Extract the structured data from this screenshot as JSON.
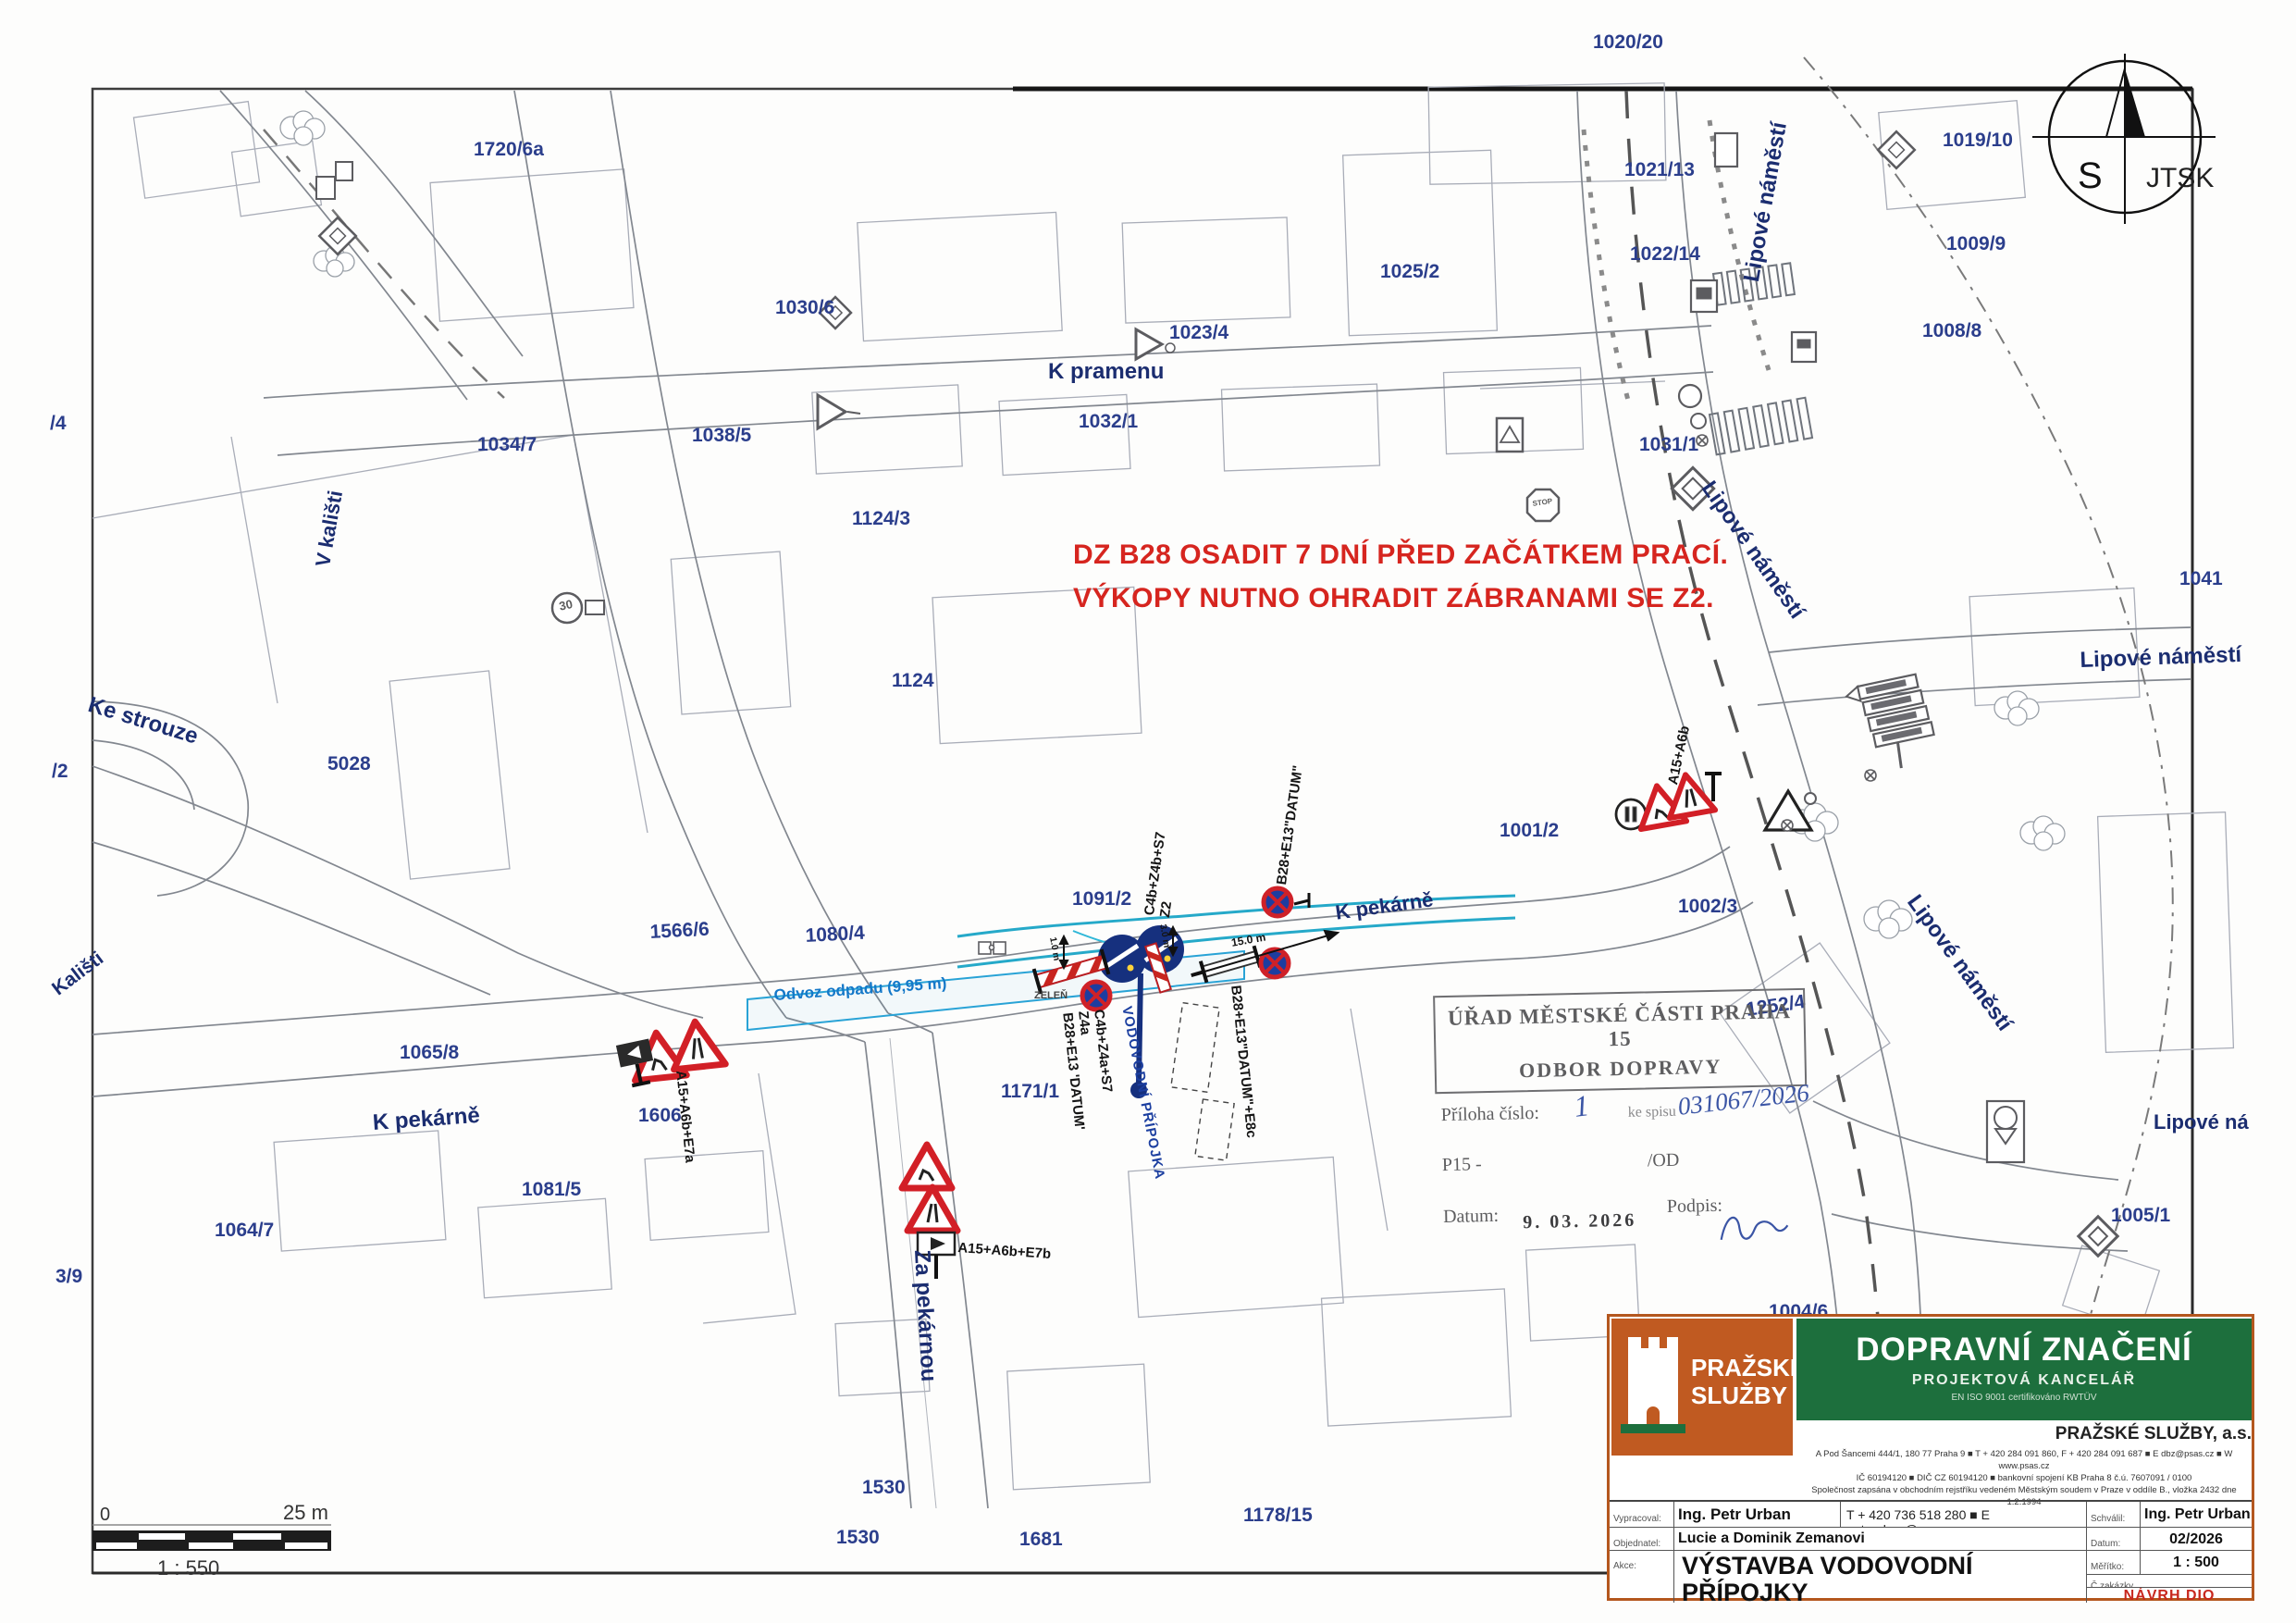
{
  "north": {
    "s": "S",
    "jtsk": "JTSK"
  },
  "scalebar": {
    "zero": "0",
    "max": "25 m",
    "ratio": "1 : 550"
  },
  "note": {
    "line1": "DZ B28 OSADIT 7 DNÍ PŘED ZAČÁTKEM PRACÍ.",
    "line2": "VÝKOPY NUTNO OHRADIT ZÁBRANAMI SE Z2."
  },
  "streets": {
    "k_pramenu": "K pramenu",
    "k_pekarne_west": "K pekárně",
    "k_pekarne_center": "K pekárně",
    "za_pekarnou": "Za pekárnou",
    "ke_strouze": "Ke strouze",
    "v_kalisti": "V kališti",
    "kalisti": "Kališti",
    "lipove_top": "Lipové náměstí",
    "lipove_mid": "Lipové náměstí",
    "lipove_right": "Lipové náměstí",
    "lipove_diag": "Lipové náměstí",
    "lipove_cut": "Lipové ná"
  },
  "parcels": {
    "p1720_6a": "1720/6a",
    "p1020_20": "1020/20",
    "p1021_13": "1021/13",
    "p1019_10": "1019/10",
    "p1022_14": "1022/14",
    "p1009_9": "1009/9",
    "p1025_2": "1025/2",
    "p1008_8": "1008/8",
    "p1030_6": "1030/6",
    "p1023_4": "1023/4",
    "p1031_1": "1031/1",
    "p1032_1": "1032/1",
    "p1038_5": "1038/5",
    "p1034_7": "1034/7",
    "p1124_3": "1124/3",
    "p1041": "1041",
    "p1124": "1124",
    "p5028": "5028",
    "p1001_2": "1001/2",
    "p1091_2": "1091/2",
    "p1002_3": "1002/3",
    "p1566_6": "1566/6",
    "p1080_4": "1080/4",
    "p1065_8": "1065/8",
    "p1606": "1606",
    "p1171_1": "1171/1",
    "p1081_5": "1081/5",
    "p1064_7": "1064/7",
    "p3_9": "3/9",
    "p1530a": "1530",
    "p1530b": "1530",
    "p1681": "1681",
    "p1178_15": "1178/15",
    "p1004_6": "1004/6",
    "p1005_1": "1005/1",
    "p1252_4": "1252/4",
    "pSlash4": "/4",
    "pSlash2": "/2"
  },
  "work": {
    "odvoz": "Odvoz odpadu (9,95 m)",
    "vodovodni": "VODOVODNÍ PŘÍPOJKA",
    "zelen": "ZELEŇ",
    "dim15": "15.0 m",
    "dim3": "3.0 m",
    "dim1": "1.0 m",
    "c4b_z4b": "C4b+Z4b+S7",
    "z2": "Z2",
    "b28_datum": "B28+E13\"DATUM\"",
    "c4b_z4a": "C4b+Z4a+S7",
    "z4a": "Z4a",
    "b28_datum2": "B28+E13 'DATUM'",
    "b28_datum_e8c": "B28+E13\"DATUM\"+E8c",
    "a15_e7a": "A15+A6b+E7a",
    "a15_e7b": "A15+A6b+E7b",
    "a15": "A15+A6b"
  },
  "signs": {
    "speed30": "30",
    "stop": "STOP"
  },
  "stamp": {
    "title1": "ÚŘAD MĚSTSKÉ ČÁSTI PRAHA 15",
    "title2": "ODBOR DOPRAVY",
    "priloha_label": "Příloha číslo:",
    "priloha_value": "1",
    "spis_label": "ke spisu",
    "spis_value": "031067/2026",
    "p15": "P15 -",
    "od": "/OD",
    "datum_label": "Datum:",
    "datum_value": "9. 03. 2026",
    "podpis_label": "Podpis:"
  },
  "titleblock": {
    "brand1": "PRAŽSKÉ",
    "brand2": "SLUŽBY",
    "banner_title": "DOPRAVNÍ ZNAČENÍ",
    "banner_sub": "PROJEKTOVÁ KANCELÁŘ",
    "banner_iso": "EN ISO 9001 certifikováno RWTÜV",
    "company": "PRAŽSKÉ SLUŽBY, a.s.",
    "addr": "A  Pod Šancemi 444/1, 180 77 Praha 9  ■  T  + 420 284 091 860,  F  + 420 284 091 687  ■  E  dbz@psas.cz  ■  W  www.psas.cz",
    "reg1": "IČ  60194120  ■  DIČ  CZ 60194120  ■  bankovní spojení KB Praha 8  č.ú. 7607091 / 0100",
    "reg2": "Společnost zapsána v obchodním rejstříku vedeném Městským soudem v Praze v oddíle B., vložka 2432 dne 1.2.1994",
    "vypracoval_label": "Vypracoval:",
    "vypracoval": "Ing. Petr Urban",
    "contact": "T + 420 736 518 280 ■ E petr.urban@psas.cz",
    "schvalil_label": "Schválil:",
    "schvalil": "Ing. Petr Urban",
    "objednatel_label": "Objednatel:",
    "objednatel": "Lucie a Dominik Zemanovi",
    "datum_label": "Datum:",
    "datum": "02/2026",
    "akce_label": "Akce:",
    "akce1": "VÝSTAVBA VODOVODNÍ PŘÍPOJKY",
    "akce2": "- ul. K Pekárně, Praha 15",
    "meritko_label": "Měřítko:",
    "meritko": "1 : 500",
    "zakazka_label": "Č.zakázky",
    "navrh": "NÁVRH DIO"
  }
}
